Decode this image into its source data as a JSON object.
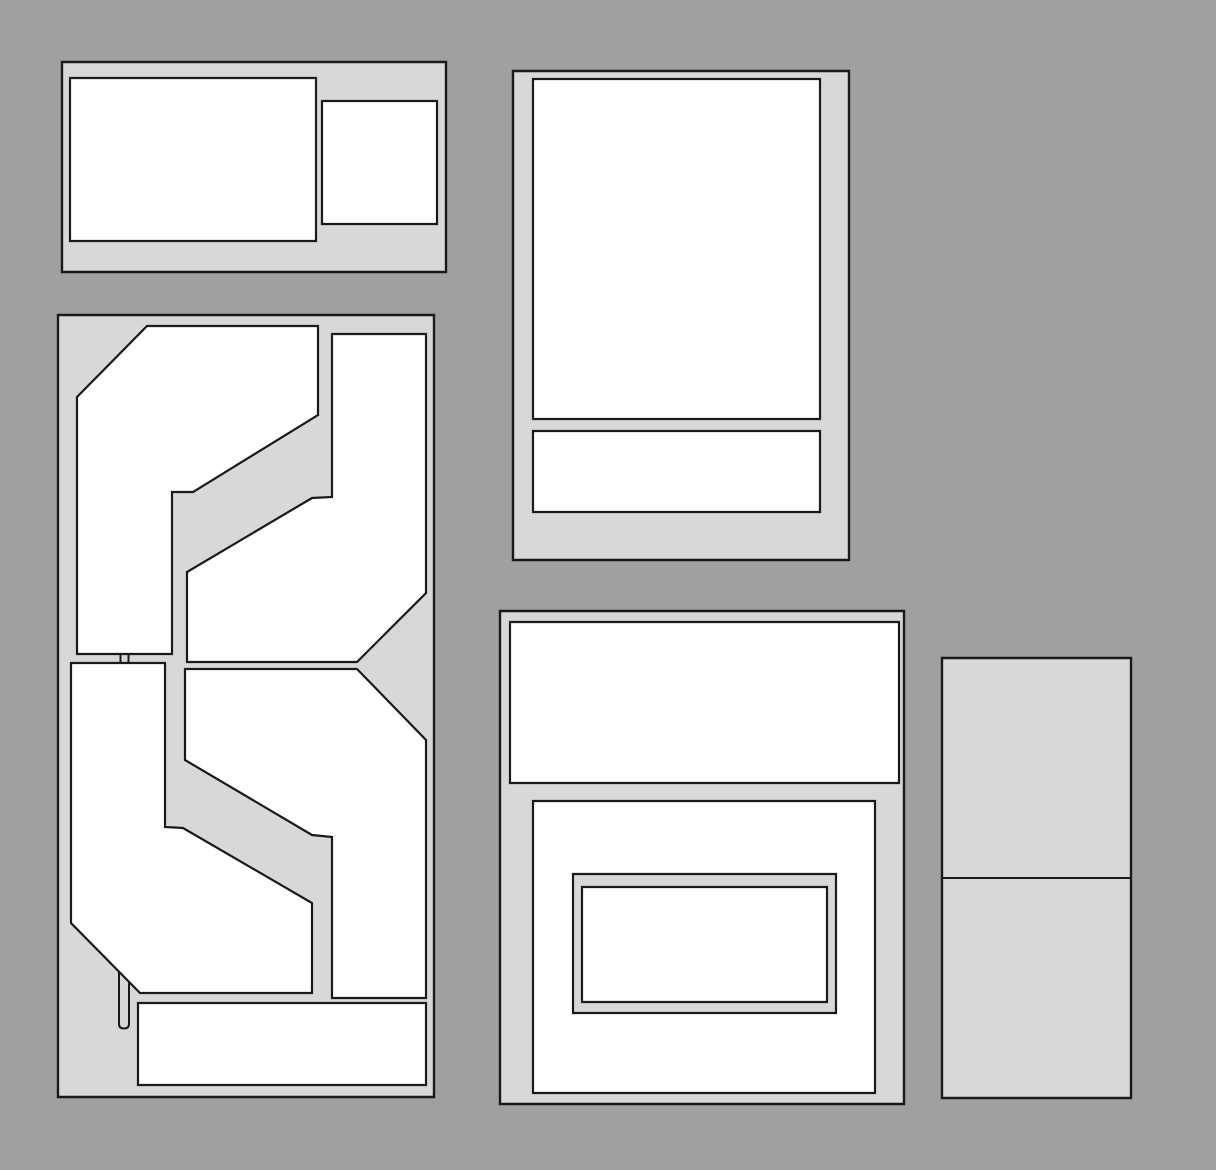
{
  "diagram": {
    "kind": "floor-plan-style block diagram",
    "text_content": "none"
  },
  "colors": {
    "background": "#a0a0a0",
    "panel_fill": "#d8d8d8",
    "shape_fill": "#ffffff",
    "outline": "#1a1a1a"
  },
  "panels": {
    "top_left": {
      "frame": "62,62 446,62 446,272 62,272",
      "large_rect": "70,78 316,78 316,241 70,241",
      "small_rect": "322,101 437,101 437,224 322,224"
    },
    "floor_plan": {
      "frame": "58,315 434,315 434,1097 58,1097",
      "room_upper_left": "77,397 147,326 318,326 318,415 193,492 172,492 172,654 77,654",
      "room_upper_right": "332,334 426,334 426,593 357,662 187,662 187,572 312,498 332,497",
      "room_lower_left": "71,663 165,663 165,827 183,828 312,903 312,993 140,993 71,923",
      "room_lower_right": "185,669 357,669 426,740 426,998 332,998 332,837 312,835 185,760",
      "bottom_rect": "138,1003 426,1003 426,1085 138,1085",
      "door_ticks": "M120.5,653.5 L120.5,663.5 M128.5,653.5 L128.5,663.5",
      "door_slot": "M119,972 L119,1024 Q119,1028.5 124,1028.5 Q129,1028.5 129,1024 L129,982"
    },
    "top_center": {
      "frame": "513,71 849,71 849,560 513,560",
      "large_rect": "533,79 820,79 820,419 533,419",
      "strip_rect": "533,431 820,431 820,512 533,512"
    },
    "bottom_center": {
      "frame": "500,611 904,611 904,1104 500,1104",
      "top_rect": "510,622 899,622 899,783 510,783",
      "large_rect": "533,801 875,801 875,1093 533,1093",
      "nested_outer": "573,874 836,874 836,1013 573,1013",
      "nested_inner": "582,887 827,887 827,1002 582,1002"
    },
    "right": {
      "frame": "942,658 1131,658 1131,1098 942,1098",
      "divider": "M942,878 L1131,878"
    }
  }
}
